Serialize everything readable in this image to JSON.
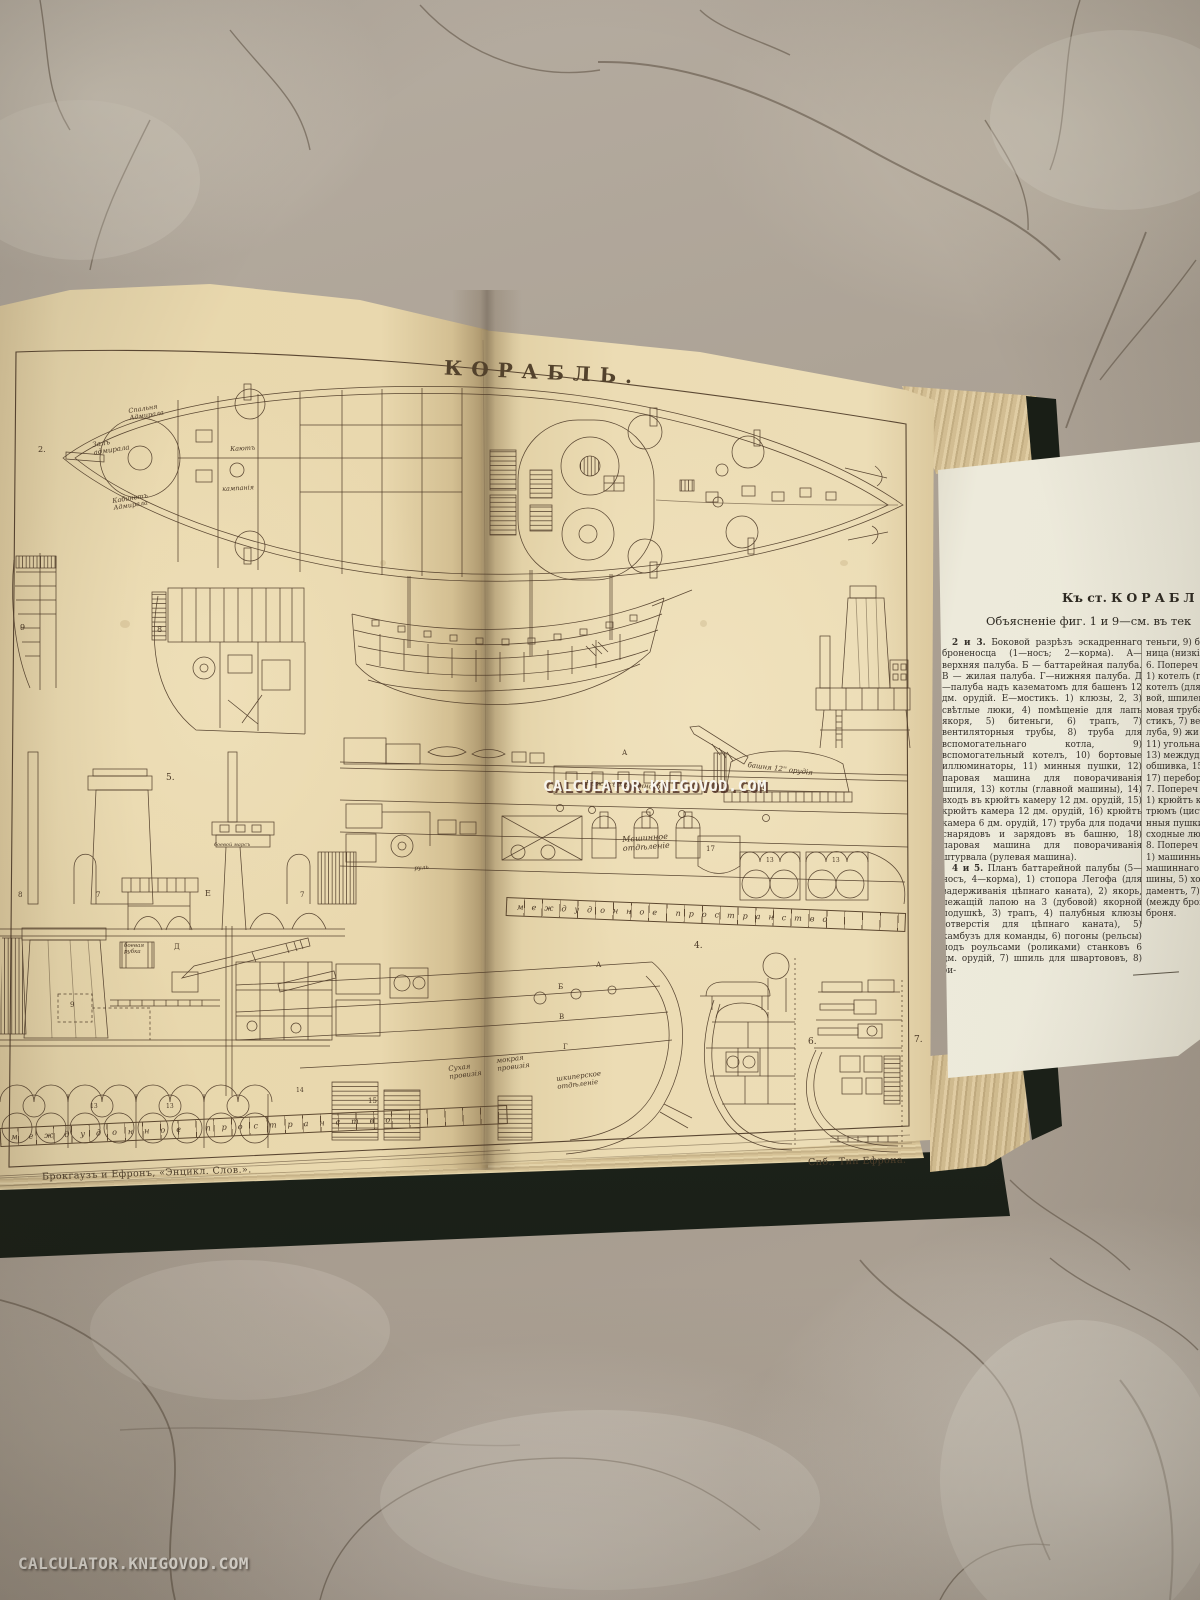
{
  "watermark": {
    "text": "CALCULATOR.KNIGOVOD.COM"
  },
  "colors": {
    "page_cream": "#e8d7ac",
    "leaf_cream": "#ebe7d8",
    "ink": "#4e3b28",
    "cover_dark": "#222820",
    "marble_base": "#aca295",
    "vein": "#5a4c3e"
  },
  "plate": {
    "title": "КОРАБЛЬ.",
    "imprint_left": "Брокгаузъ и Ефронъ, «Энцикл. Слов.».",
    "imprint_right": "Спб., Тип Ефрона.",
    "strip_mid_text": "междудонное пространство",
    "strip_bottom_text": "междудонное пространство",
    "labels": [
      {
        "t": "Спальня\nАдмирала",
        "x": 128,
        "y": 408,
        "r": -9,
        "s": 6.5,
        "c": "cur"
      },
      {
        "t": "Залъ\nадмирала",
        "x": 92,
        "y": 442,
        "r": -9,
        "s": 7,
        "c": "cur"
      },
      {
        "t": "Кабинетъ\nАдмирала",
        "x": 112,
        "y": 498,
        "r": -9,
        "s": 6.5,
        "c": "cur"
      },
      {
        "t": "Каютъ",
        "x": 230,
        "y": 446,
        "r": -3,
        "s": 6.5,
        "c": "cur"
      },
      {
        "t": "кампанія",
        "x": 222,
        "y": 486,
        "r": -3,
        "s": 6.5,
        "c": "cur"
      },
      {
        "t": "Кожухъ машиннаго",
        "x": 586,
        "y": 780,
        "r": 3,
        "s": 7,
        "c": "cur"
      },
      {
        "t": "башня 12'' орудія",
        "x": 748,
        "y": 762,
        "r": 7,
        "s": 7,
        "c": "cur"
      },
      {
        "t": "Машинное\nотдѣленіе",
        "x": 622,
        "y": 836,
        "r": -4,
        "s": 8,
        "c": "cur"
      },
      {
        "t": "боевой марсъ",
        "x": 214,
        "y": 843,
        "r": 0,
        "s": 5,
        "c": "cur"
      },
      {
        "t": "боевая\nрубка",
        "x": 124,
        "y": 944,
        "r": 0,
        "s": 5.5,
        "c": "cur"
      },
      {
        "t": "Сухая\nпровизія",
        "x": 448,
        "y": 1066,
        "r": -7,
        "s": 7,
        "c": "cur"
      },
      {
        "t": "мокрая\nпровизія",
        "x": 496,
        "y": 1058,
        "r": -7,
        "s": 7,
        "c": "cur"
      },
      {
        "t": "шкиперское\nотдѣленіе",
        "x": 556,
        "y": 1076,
        "r": -7,
        "s": 7,
        "c": "cur"
      },
      {
        "t": "руль",
        "x": 414,
        "y": 866,
        "r": -5,
        "s": 6,
        "c": "cur"
      },
      {
        "t": "2.",
        "x": 38,
        "y": 446,
        "s": 8
      },
      {
        "t": "9",
        "x": 20,
        "y": 624,
        "s": 8
      },
      {
        "t": "8",
        "x": 157,
        "y": 626,
        "s": 8
      },
      {
        "t": "5.",
        "x": 166,
        "y": 774,
        "s": 9
      },
      {
        "t": "Е",
        "x": 205,
        "y": 890,
        "s": 8
      },
      {
        "t": "А",
        "x": 622,
        "y": 750,
        "s": 7
      },
      {
        "t": "17",
        "x": 706,
        "y": 846,
        "s": 7
      },
      {
        "t": "13",
        "x": 766,
        "y": 858,
        "s": 6
      },
      {
        "t": "13",
        "x": 832,
        "y": 858,
        "s": 6
      },
      {
        "t": "8",
        "x": 18,
        "y": 892,
        "s": 7
      },
      {
        "t": "7",
        "x": 96,
        "y": 892,
        "s": 7
      },
      {
        "t": "7",
        "x": 300,
        "y": 892,
        "s": 7
      },
      {
        "t": "Д",
        "x": 174,
        "y": 944,
        "s": 7
      },
      {
        "t": "9",
        "x": 70,
        "y": 1002,
        "s": 7
      },
      {
        "t": "А",
        "x": 596,
        "y": 962,
        "s": 7
      },
      {
        "t": "Б",
        "x": 558,
        "y": 984,
        "s": 7
      },
      {
        "t": "В",
        "x": 559,
        "y": 1014,
        "s": 7
      },
      {
        "t": "Г",
        "x": 563,
        "y": 1044,
        "s": 7
      },
      {
        "t": "13",
        "x": 90,
        "y": 1104,
        "s": 6
      },
      {
        "t": "13",
        "x": 166,
        "y": 1104,
        "s": 6
      },
      {
        "t": "14",
        "x": 296,
        "y": 1088,
        "s": 6
      },
      {
        "t": "15",
        "x": 368,
        "y": 1098,
        "s": 7
      },
      {
        "t": "4.",
        "x": 694,
        "y": 942,
        "s": 9
      },
      {
        "t": "6.",
        "x": 808,
        "y": 1038,
        "s": 9
      },
      {
        "t": "7.",
        "x": 914,
        "y": 1036,
        "s": 9
      }
    ]
  },
  "leaf": {
    "heading_prefix": "Къ ст.",
    "heading_word": "КОРАБЛ",
    "subheading": "Объясненіе фиг. 1 и 9—см. въ тек",
    "col1": [
      {
        "lead": "2 и 3.",
        "text": "Боковой разрѣзъ эскадреннаго броненосца (1—носъ; 2—корма). А—верхняя палуба. Б — баттарейная палуба. В — жилая палуба. Г—нижняя палуба. Д—палуба надъ казематомъ для башенъ 12 дм. орудій. Е—мостикъ. 1) клюзы, 2, 3) свѣтлые люки, 4) помѣщеніе для лапъ якоря, 5) битеньги, 6) трапъ, 7) вентиляторныя трубы, 8) труба для вспомогательнаго котла, 9) вспомогательный котелъ, 10) бортовые иллюминаторы, 11) минныя пушки, 12) паровая машина для поворачиванія шпиля, 13) котлы (главной машины), 14) входъ въ крюйтъ камеру 12 дм. орудій, 15) крюйтъ камера 12 дм. орудій, 16) крюйтъ камера 6 дм. орудій, 17) труба для подачи снарядовъ и зарядовъ въ башню, 18) паровая машина для поворачиванія штурвала (рулевая машина)."
      },
      {
        "lead": "4 и 5.",
        "text": "Планъ баттарейной палубы (5—носъ, 4—корма), 1) стопора Легофа (для задерживанія цѣпнаго каната), 2) якорь, лежащій лапою на 3 (дубовой) якорной подушкѣ, 3) трапъ, 4) палубныя клюзы (отверстія для цѣпнаго каната), 5) камбузъ для команды, 6) погоны (рельсы) подъ роульсами (роликами) станковъ 6 дм. орудій, 7) шпиль для швартововъ, 8) би-"
      }
    ],
    "col2_lines": [
      "теньги, 9) борт",
      "ница (низкіе ш",
      "6. Попереч",
      "1) котелъ (глав",
      "котелъ (для вс",
      "вой, шпилевой",
      "мовая труба,",
      "стикъ, 7) верх",
      "луба, 9) жи",
      "11) угольная",
      "13) междудон",
      "обшивка, 15)",
      "17) переборка",
      "7. Попереч",
      "1) крюйтъ ка",
      "трюмъ (цисте",
      "нныя пушки,",
      "сходные люк",
      "8. Попереч",
      "1) машинный",
      "машиннаго л",
      "шины, 5) хо",
      "даментъ, 7)",
      "(между брон",
      "броня."
    ]
  }
}
